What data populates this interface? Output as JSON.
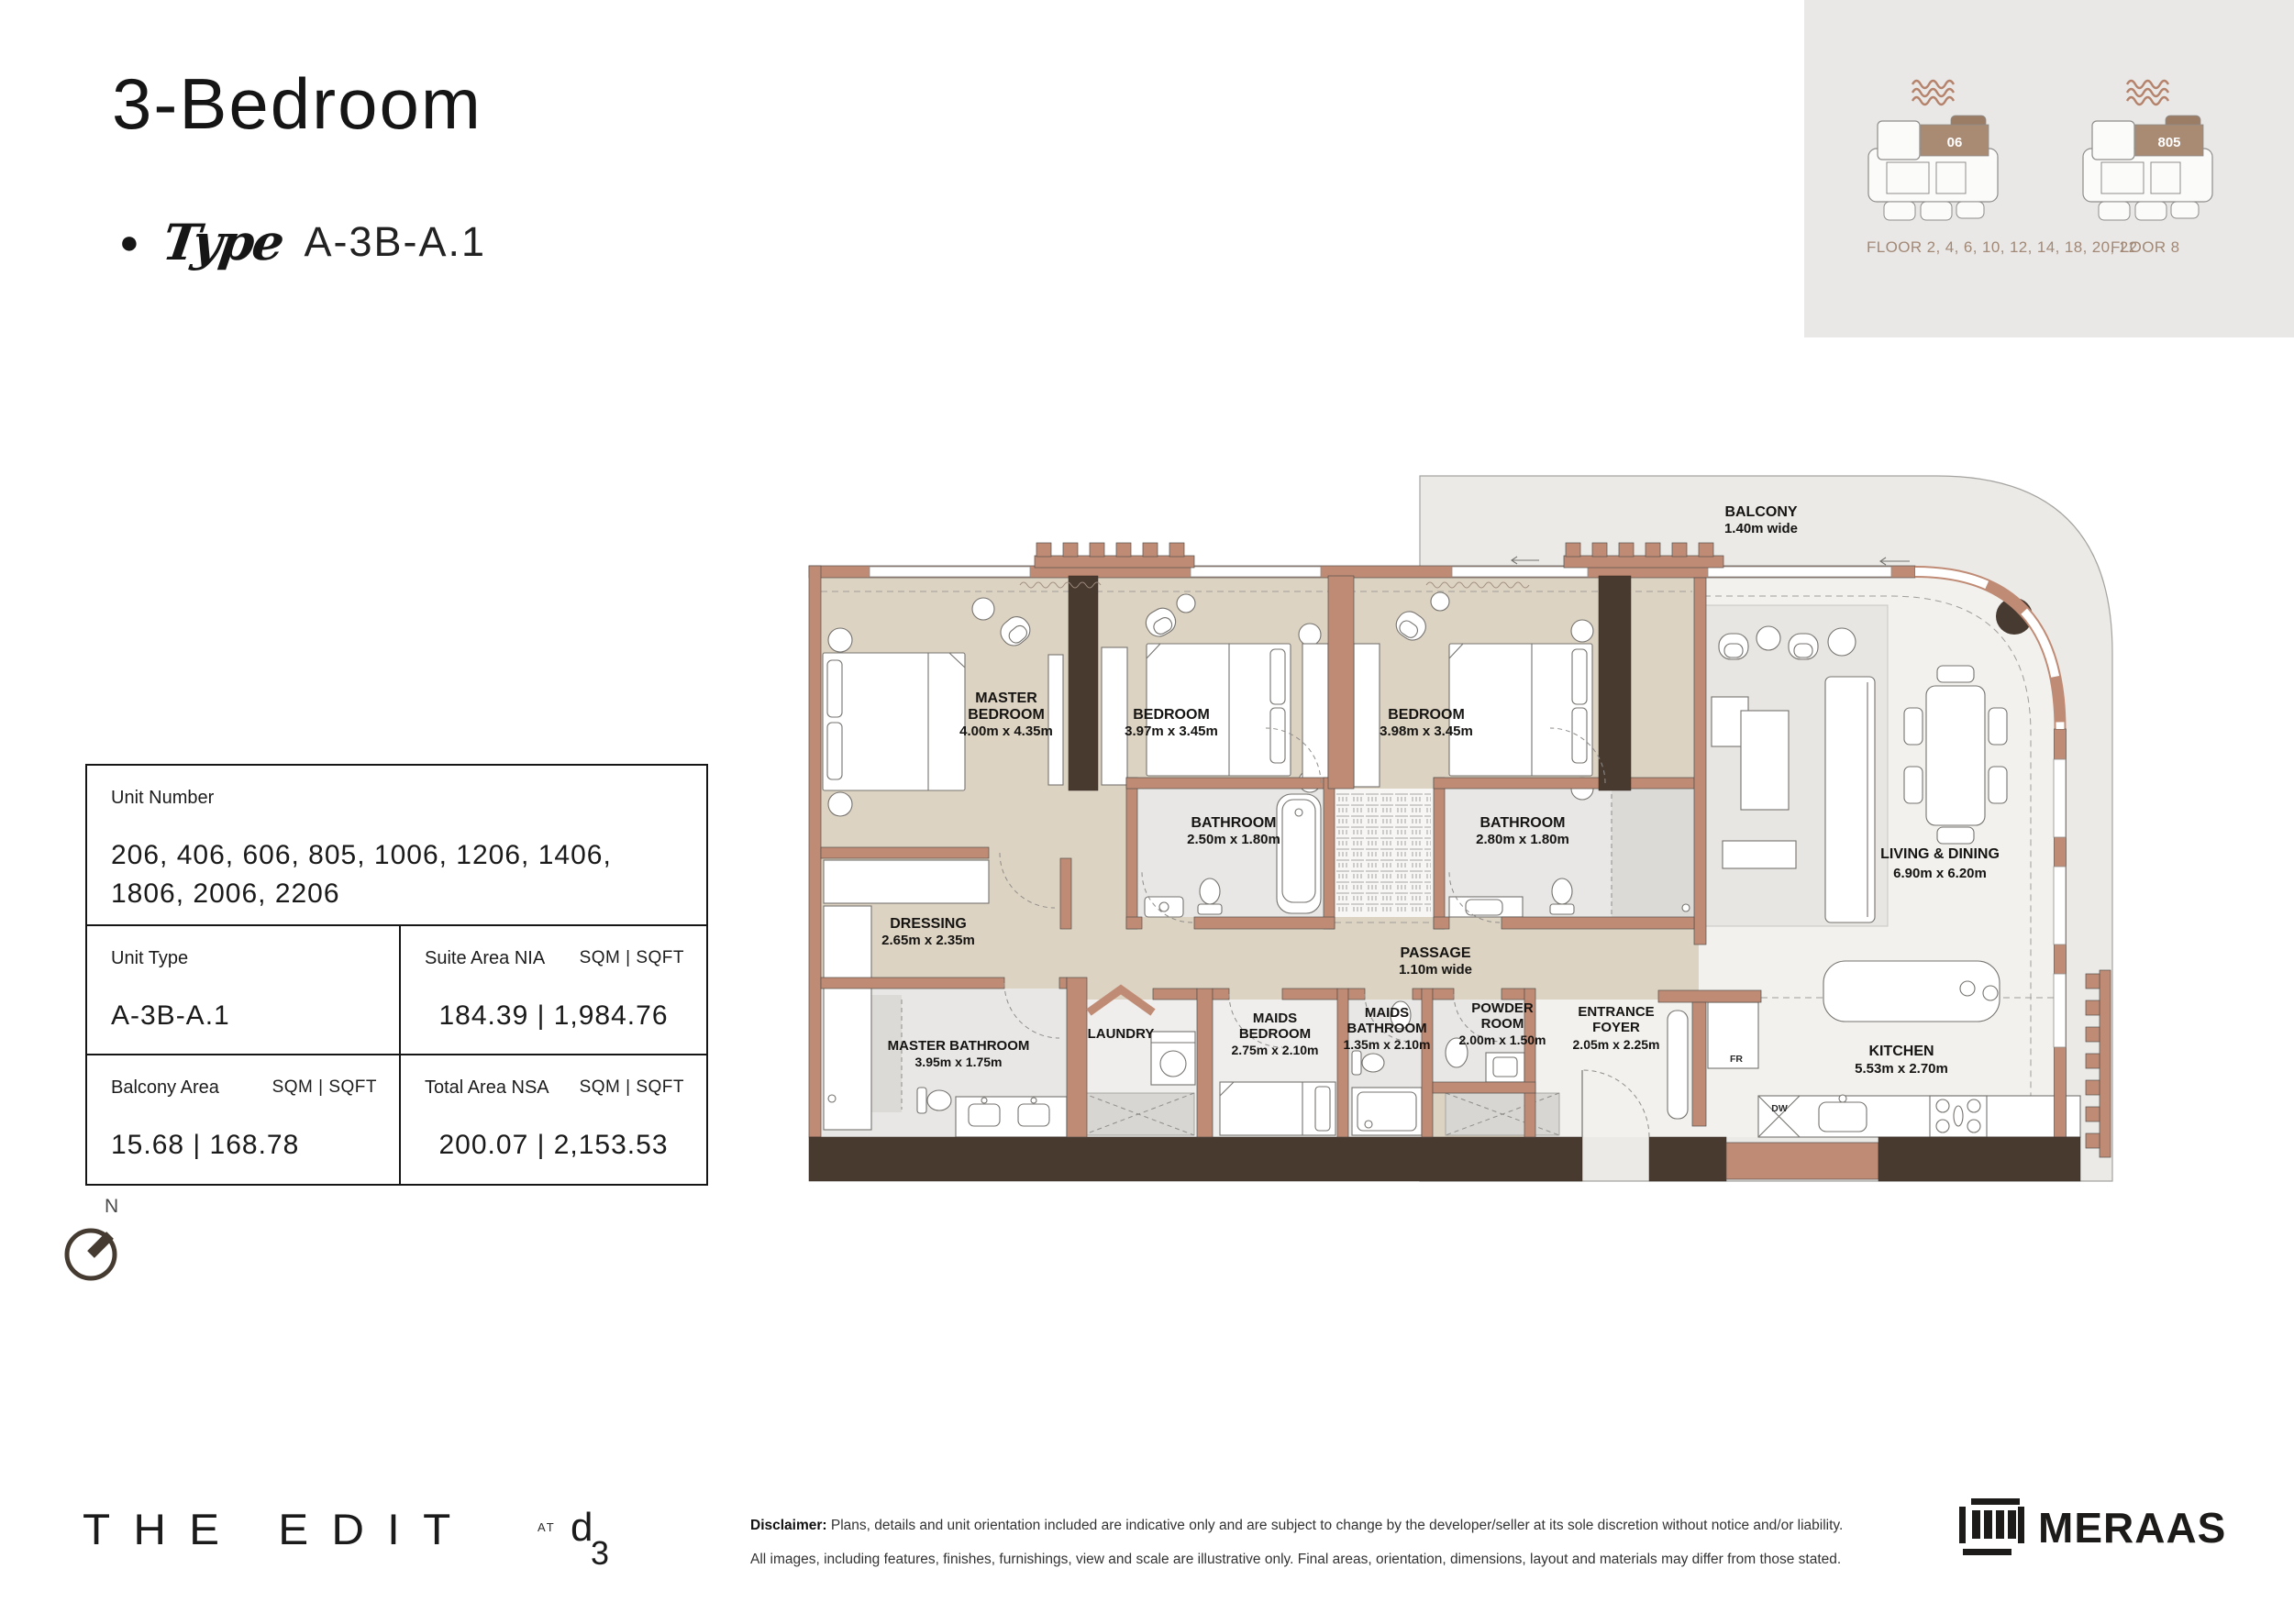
{
  "header": {
    "title": "3-Bedroom",
    "bullet": "●",
    "type_label": "Type",
    "type_value": "A-3B-A.1"
  },
  "floor_key": {
    "diagrams": [
      {
        "unit": "06",
        "floors_label": "FLOOR 2, 4, 6, 10, 12, 14, 18, 20, 22"
      },
      {
        "unit": "805",
        "floors_label": "FLOOR 8"
      }
    ]
  },
  "info_table": {
    "unit_number_label": "Unit Number",
    "unit_number_value": "206, 406, 606, 805, 1006, 1206, 1406, 1806, 2006, 2206",
    "unit_type_label": "Unit Type",
    "unit_type_value": "A-3B-A.1",
    "suite_area_label": "Suite Area NIA",
    "suite_area_units": "SQM | SQFT",
    "suite_area_value": "184.39 | 1,984.76",
    "balcony_area_label": "Balcony Area",
    "balcony_area_units": "SQM | SQFT",
    "balcony_area_value": "15.68 | 168.78",
    "total_area_label": "Total Area NSA",
    "total_area_units": "SQM | SQFT",
    "total_area_value": "200.07 | 2,153.53"
  },
  "compass": {
    "north_label": "N"
  },
  "floor_plan": {
    "rooms": [
      {
        "id": "master-bedroom",
        "lines": [
          "MASTER",
          "BEDROOM"
        ],
        "dims": "4.00m x 4.35m"
      },
      {
        "id": "bedroom-2",
        "lines": [
          "BEDROOM"
        ],
        "dims": "3.97m x 3.45m"
      },
      {
        "id": "bedroom-3",
        "lines": [
          "BEDROOM"
        ],
        "dims": "3.98m x 3.45m"
      },
      {
        "id": "bathroom-2",
        "lines": [
          "BATHROOM"
        ],
        "dims": "2.50m x 1.80m"
      },
      {
        "id": "bathroom-3",
        "lines": [
          "BATHROOM"
        ],
        "dims": "2.80m x 1.80m"
      },
      {
        "id": "dressing",
        "lines": [
          "DRESSING"
        ],
        "dims": "2.65m x 2.35m"
      },
      {
        "id": "passage",
        "lines": [
          "PASSAGE"
        ],
        "dims": "1.10m wide"
      },
      {
        "id": "master-bathroom",
        "lines": [
          "MASTER BATHROOM"
        ],
        "dims": "3.95m x 1.75m"
      },
      {
        "id": "laundry",
        "lines": [
          "LAUNDRY"
        ],
        "dims": ""
      },
      {
        "id": "maids-bedroom",
        "lines": [
          "MAIDS",
          "BEDROOM"
        ],
        "dims": "2.75m x 2.10m"
      },
      {
        "id": "maids-bathroom",
        "lines": [
          "MAIDS",
          "BATHROOM"
        ],
        "dims": "1.35m x 2.10m"
      },
      {
        "id": "powder-room",
        "lines": [
          "POWDER",
          "ROOM"
        ],
        "dims": "2.00m x 1.50m"
      },
      {
        "id": "entrance-foyer",
        "lines": [
          "ENTRANCE",
          "FOYER"
        ],
        "dims": "2.05m x 2.25m"
      },
      {
        "id": "kitchen",
        "lines": [
          "KITCHEN"
        ],
        "dims": "5.53m x 2.70m"
      },
      {
        "id": "living-dining",
        "lines": [
          "LIVING & DINING"
        ],
        "dims": "6.90m x 6.20m"
      },
      {
        "id": "balcony",
        "lines": [
          "BALCONY"
        ],
        "dims": "1.40m wide"
      }
    ],
    "appliances": {
      "fridge": "FR",
      "dishwasher": "DW"
    }
  },
  "footer": {
    "brand": "THE EDIT",
    "brand_at": "AT",
    "d3": {
      "d": "d",
      "three": "3"
    },
    "disclaimer_label": "Disclaimer:",
    "disclaimer_line1": "Plans, details and unit orientation included are indicative only and are subject to change by the developer/seller at its sole discretion without notice and/or liability.",
    "disclaimer_line2": "All images, including features, finishes, furnishings, view and scale are illustrative only. Final areas, orientation, dimensions, layout and materials may differ from those stated.",
    "meraas": "MERAAS"
  },
  "colors": {
    "wall_salmon": "#c08b75",
    "wall_dark": "#483a2f",
    "floor_beige": "#ddd3c2",
    "floor_light": "#f2f1ee",
    "balcony_fill": "#ebeae7",
    "panel_bg": "#e9e8e6",
    "unit_highlight_brown": "#a98a72",
    "floor_label_brown": "#a28876"
  }
}
